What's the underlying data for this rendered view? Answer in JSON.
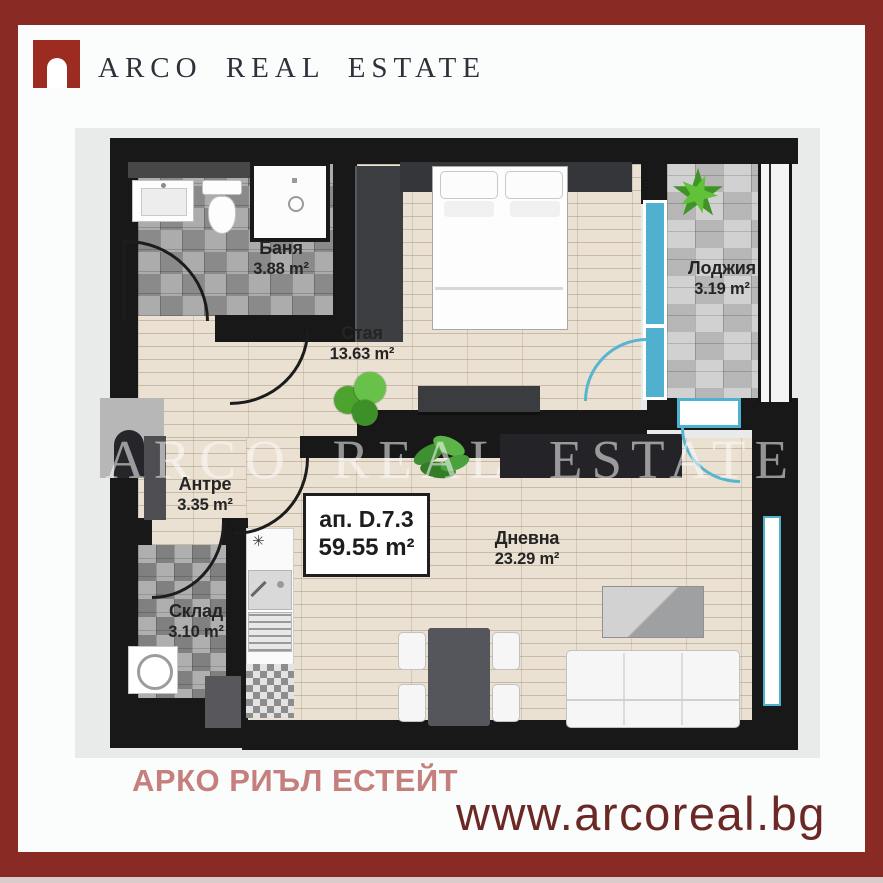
{
  "brand": {
    "logo_text": "ARCO REAL ESTATE",
    "watermark": "ARCO REAL ESTATE",
    "footer_name": "АРКО РИЪЛ ЕСТЕЙТ",
    "website": "www.arcoreal.bg",
    "colors": {
      "frame_red": "#8a2a25",
      "logo_red": "#9c2b22",
      "wall_black": "#181818",
      "window_teal": "#4fb0cf",
      "footer_pink": "#c5807e",
      "website_maroon": "#6b2824"
    }
  },
  "plan": {
    "apartment": {
      "label": "ап. D.7.3",
      "area": "59.55 m²"
    },
    "rooms": [
      {
        "id": "bathroom",
        "name": "Баня",
        "area": "3.88 m²"
      },
      {
        "id": "bedroom",
        "name": "Стая",
        "area": "13.63 m²"
      },
      {
        "id": "loggia",
        "name": "Лоджия",
        "area": "3.19 m²"
      },
      {
        "id": "hallway",
        "name": "Антре",
        "area": "3.35 m²"
      },
      {
        "id": "storage",
        "name": "Склад",
        "area": "3.10 m²"
      },
      {
        "id": "living",
        "name": "Дневна",
        "area": "23.29 m²"
      }
    ]
  },
  "icons": {
    "logo_mark": "arch-doorway",
    "plants": "potted-plant",
    "appliances": [
      "washing-machine",
      "stove",
      "kitchen-sink",
      "shower",
      "toilet",
      "bathroom-sink"
    ]
  }
}
